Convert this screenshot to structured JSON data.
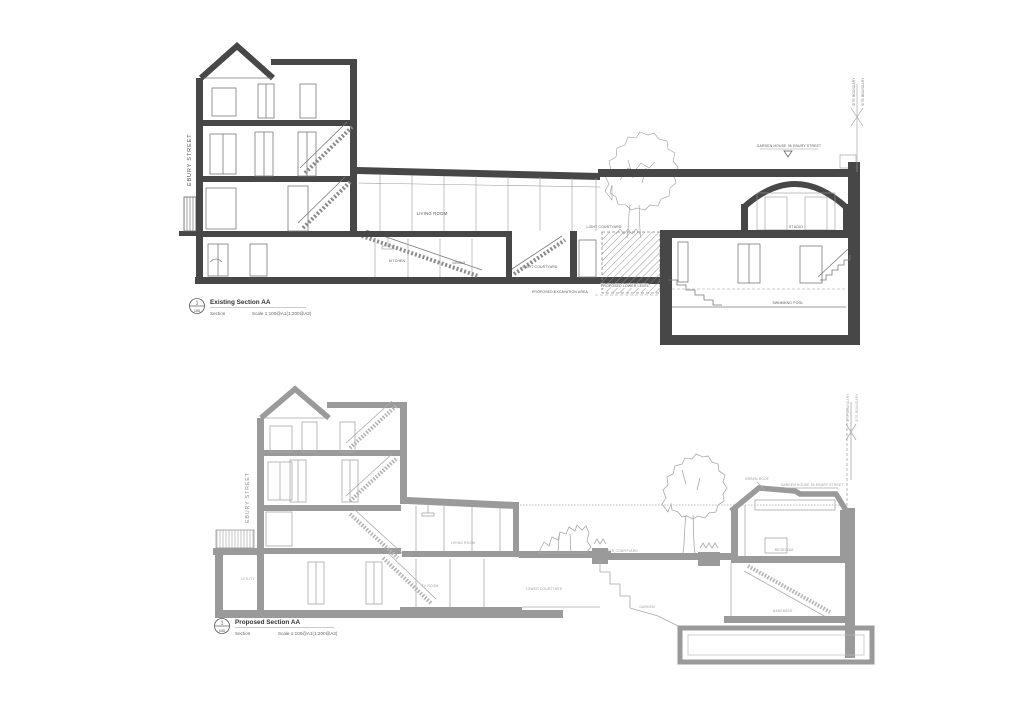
{
  "sheet": {
    "background": "#ffffff",
    "ink_dark": "#474747",
    "ink_grey": "#9a9a9a",
    "label_color": "#555555"
  },
  "existing": {
    "title": "Existing Section AA",
    "ref_number": "1",
    "ref_scale": "100",
    "type_label": "Section",
    "scale_label": "Scale 1:100@A1(1:200@A3)",
    "street": "EBURY STREET",
    "garden_house_note": "GARDEN HOUSE 36 EBURY STREET",
    "rooms": {
      "living_room": "LIVING ROOM",
      "kitchen": "KITCHEN",
      "dining": "DINING",
      "light_courtyard": "LIGHT COURTYARD",
      "rear_courtyard": "LIGHT COURTYARD",
      "studio": "STUDIO",
      "swimming_pool": "SWIMMING POOL"
    },
    "annotations": {
      "excavation": "PROPOSED EXCAVATION AREA",
      "lower_level": "PROPOSED LOWER LEVEL",
      "boundary_a": "SITE BOUNDARY",
      "boundary_b": "SITE BOUNDARY"
    }
  },
  "proposed": {
    "title": "Proposed Section AA",
    "ref_number": "1",
    "ref_scale": "100",
    "type_label": "Section",
    "scale_label": "Scale 1:100@A1(1:200@A3)",
    "street": "EBURY STREET",
    "garden_house_note": "GARDEN HOUSE 36 EBURY STREET",
    "green_roof_note": "GREEN ROOF",
    "rooms": {
      "living_room": "LIVING ROOM",
      "utility": "UTILITY",
      "tv_room": "TV ROOM",
      "upper_courtyard": "UPPER COURTYARD",
      "lower_courtyard": "LOWER COURTYARD",
      "garden": "GARDEN",
      "bedroom": "BEDROOM",
      "basement": "BASEMENT"
    },
    "annotations": {
      "boundary_a": "SITE BOUNDARY",
      "boundary_b": "SITE BOUNDARY"
    }
  }
}
